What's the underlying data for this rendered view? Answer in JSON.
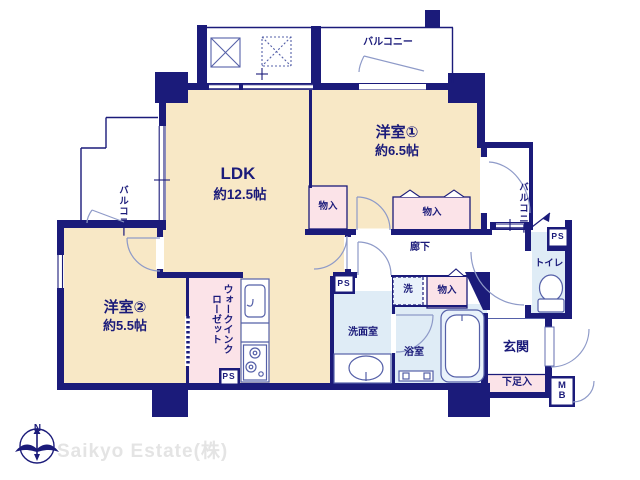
{
  "palette": {
    "wall_navy": "#1b1b7a",
    "room_cream": "#f8e8c6",
    "closet_pink": "#fbe3e8",
    "wet_blue": "#dfecf6",
    "fixture_line": "#5560a8",
    "door_arc": "#8e9ac8",
    "watermark_gray": "#e4e4e4"
  },
  "rooms": {
    "ldk": {
      "label": "LDK",
      "area": "約12.5帖"
    },
    "western1": {
      "label": "洋室①",
      "area": "約6.5帖"
    },
    "western2": {
      "label": "洋室②",
      "area": "約5.5帖"
    },
    "balcony_top": {
      "label": "バルコニー"
    },
    "balcony_left": {
      "label": "バルコニー"
    },
    "balcony_right": {
      "label": "バルコニー"
    },
    "hallway": {
      "label": "廊下"
    },
    "toilet": {
      "label": "トイレ"
    },
    "washroom": {
      "label": "洗面室"
    },
    "bathroom": {
      "label": "浴室"
    },
    "entrance": {
      "label": "玄関"
    },
    "wic": {
      "label": "ウォークインクローゼット"
    },
    "laundry": {
      "label": "洗"
    },
    "storage_1": {
      "label": "物入"
    },
    "storage_2": {
      "label": "物入"
    },
    "storage_3": {
      "label": "物入"
    },
    "shoe_cabinet": {
      "label": "下足入"
    },
    "ps_1": {
      "label": "PS"
    },
    "ps_2": {
      "label": "PS"
    },
    "ps_3": {
      "label": "PS"
    },
    "meter_box": {
      "label": "MB"
    }
  },
  "compass": {
    "north": "N"
  },
  "footer": {
    "company": "Saikyo Estate(株)"
  }
}
